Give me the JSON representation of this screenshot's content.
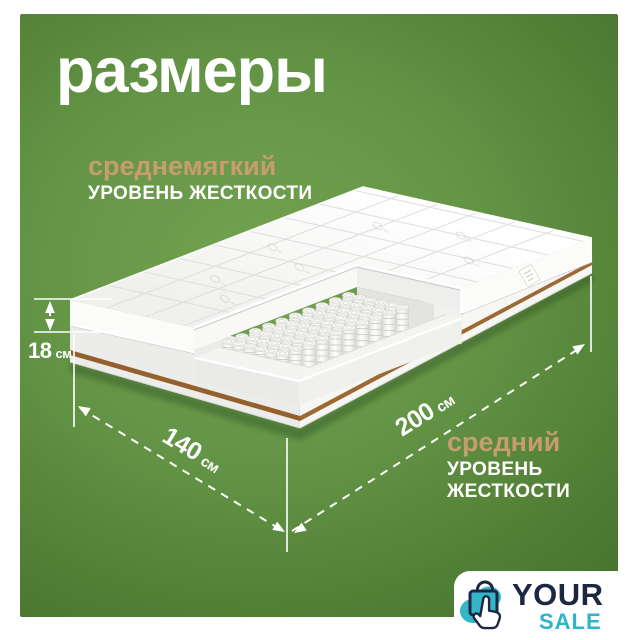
{
  "title": "размеры",
  "firmness_top": {
    "level": "среднемягкий",
    "label": "УРОВЕНЬ ЖЕСТКОСТИ"
  },
  "firmness_bottom": {
    "level": "средний",
    "label": "УРОВЕНЬ ЖЕСТКОСТИ"
  },
  "dimensions": {
    "height": {
      "value": "18",
      "unit": "см"
    },
    "width": {
      "value": "140",
      "unit": "см"
    },
    "length": {
      "value": "200",
      "unit": "см"
    }
  },
  "logo": {
    "line1": "YOUR",
    "line2": "SALE"
  },
  "icons": {
    "logo_icon": "shopping-bag-click-icon"
  },
  "colors": {
    "background_green": "#5f8f3f",
    "accent_tan": "#c79d6f",
    "text_white": "#ffffff",
    "coir_brown": "#8a5930",
    "logo_navy": "#1c2742",
    "logo_teal": "#2db5c8"
  }
}
